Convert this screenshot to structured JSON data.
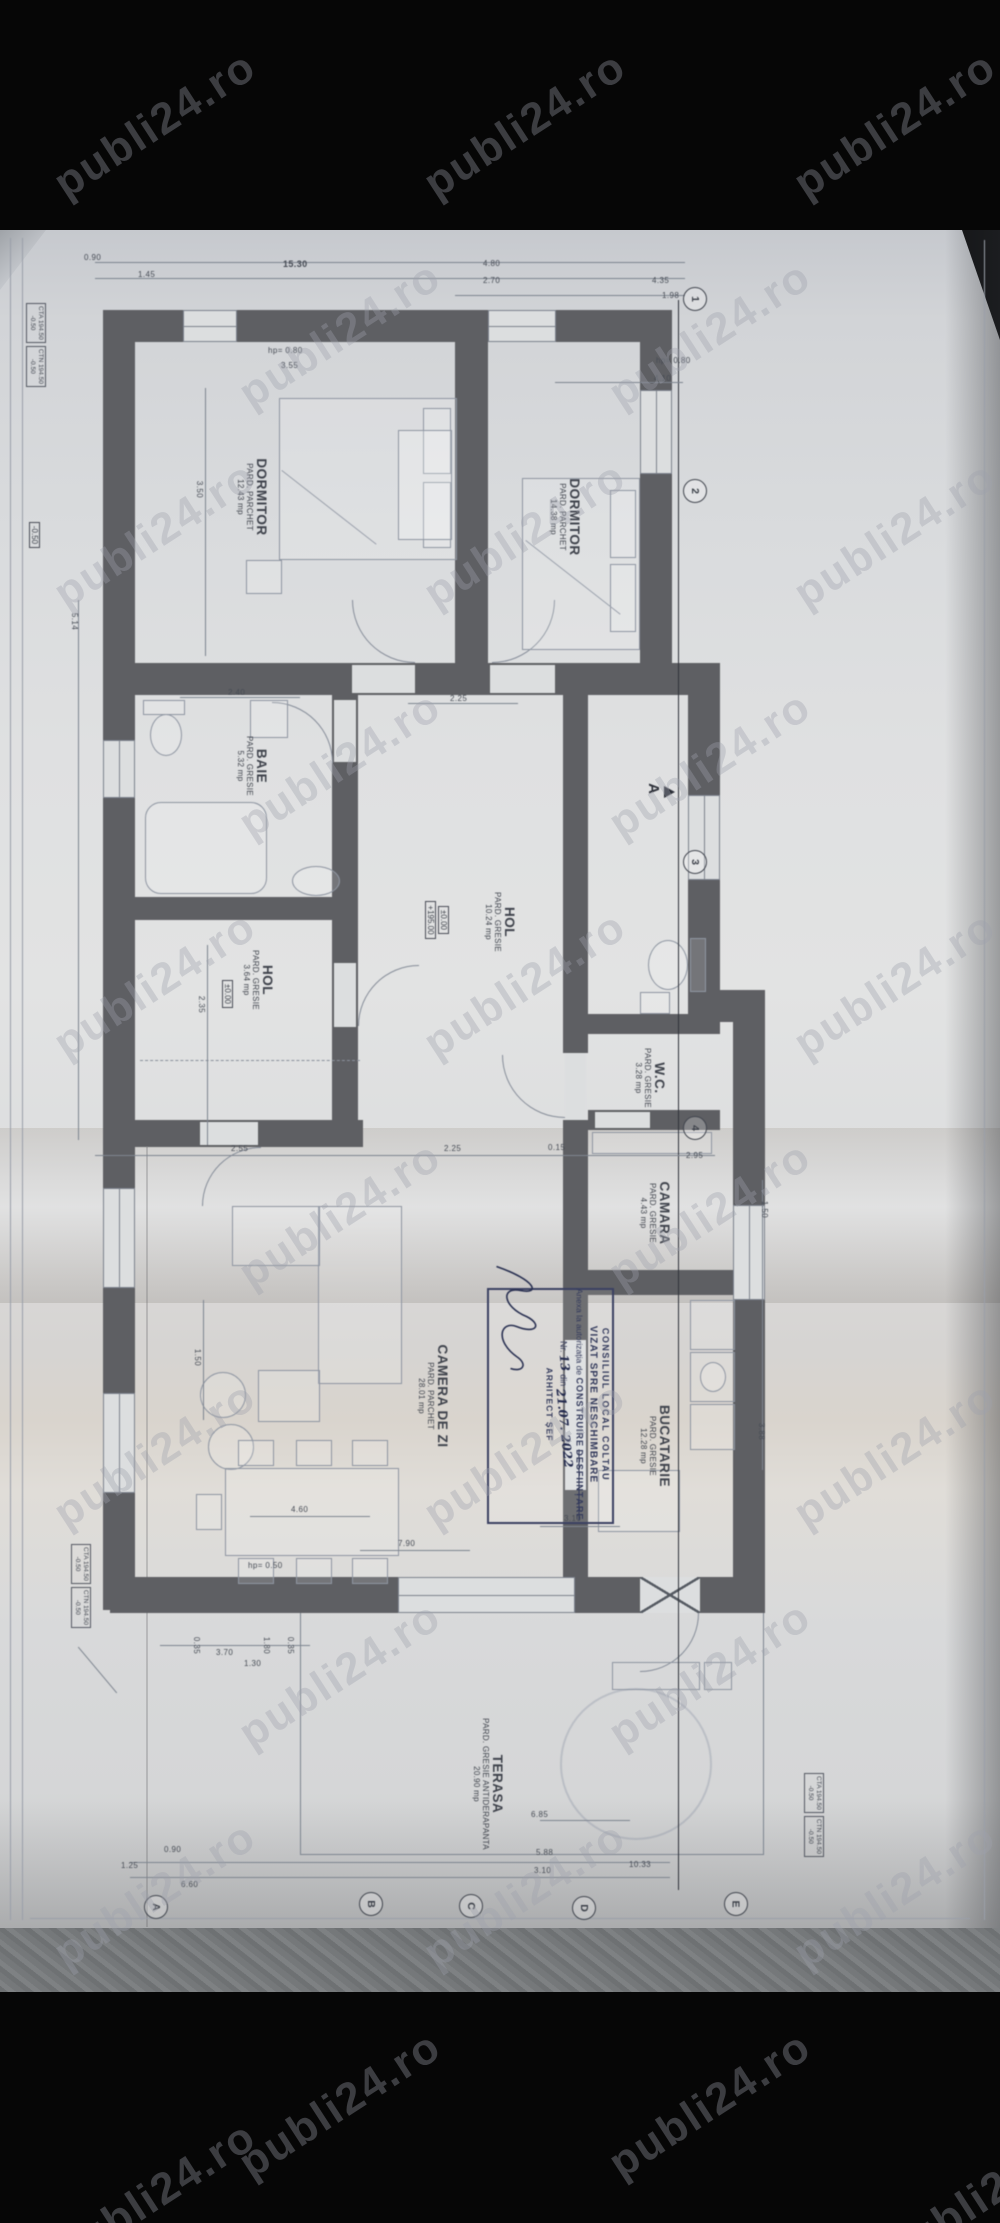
{
  "watermark": {
    "text": "publi24.ro"
  },
  "rooms": [
    {
      "name": "DORMITOR",
      "floor": "PARD. PARCHET",
      "area": "12.43 mp"
    },
    {
      "name": "DORMITOR",
      "floor": "PARD. PARCHET",
      "area": "14.38 mp"
    },
    {
      "name": "BAIE",
      "floor": "PARD. GRESIE",
      "area": "5.32 mp"
    },
    {
      "name": "HOL",
      "floor": "PARD. GRESIE",
      "area": "10.24 mp"
    },
    {
      "name": "HOL",
      "floor": "PARD. GRESIE",
      "area": "3.64 mp"
    },
    {
      "name": "W.C.",
      "floor": "PARD. GRESIE",
      "area": "3.28 mp"
    },
    {
      "name": "CAMARA",
      "floor": "PARD. GRESIE",
      "area": "4.43 mp"
    },
    {
      "name": "BUCATARIE",
      "floor": "PARD. GRESIE",
      "area": "12.28 mp"
    },
    {
      "name": "CAMERA DE ZI",
      "floor": "PARD. PARCHET",
      "area": "28.01 mp"
    },
    {
      "name": "TERASA",
      "floor": "PARD. GRESIE ANTIDERAPANTA",
      "area": "20.90 mp"
    }
  ],
  "elevations": {
    "hol_main_1": "±0.00",
    "hol_main_2": "+195.00",
    "hol_small": "±0.00",
    "left_edge": "-0.50"
  },
  "stamp": {
    "authority": "CONSILIUL LOCAL COLTAU",
    "title": "VIZAT SPRE NESCHIMBARE",
    "annex": "Anexa la autorizația de",
    "opt1": "CONSTRUIRE",
    "opt2": "DESFIINȚARE",
    "nr_label": "Nr.",
    "nr_value": "13",
    "din_label": "din",
    "date_value": "21.07. 2022",
    "signer": "ARHITECT ȘEF"
  },
  "callouts": {
    "cta_line1": "CTA 194.50",
    "cta_line2": "-0.50",
    "ctn_line1": "CTN 194.50",
    "ctn_line2": "-0.50"
  },
  "grid": {
    "cols": [
      "1",
      "2",
      "3",
      "4"
    ],
    "rows": [
      "A",
      "B",
      "C",
      "D",
      "E"
    ]
  },
  "section": {
    "label": "A"
  },
  "dims": {
    "t1": "0.90",
    "t2": "1.45",
    "t3": "15.30",
    "t4": "4.80",
    "t5": "2.70",
    "t6": "4.35",
    "t7": "1.98",
    "w1": "hp= 0.80",
    "w2": "3.55",
    "w3": "hp= 0.80",
    "w4": "4.10",
    "m1": "3.50",
    "m2": "2.40",
    "m3": "2.25",
    "m4": "5.14",
    "m5": "2.35",
    "m6": "2.55",
    "m7": "0.15",
    "m8": "2.95",
    "m9": "1.50",
    "m10": "2.25",
    "m11": "1.50",
    "m12": "3.88",
    "b1": "4.60",
    "b2": "7.90",
    "b3": "3.10",
    "b4": "hp= 0.50",
    "b5": "6.85",
    "b6": "0.35",
    "b7": "3.70",
    "b8": "1.80",
    "b9": "0.35",
    "b10": "5.88",
    "b11": "3.10",
    "b12": "10.33",
    "b13": "6.60",
    "b14": "1.25",
    "b15": "0.90",
    "b16": "1.30"
  }
}
